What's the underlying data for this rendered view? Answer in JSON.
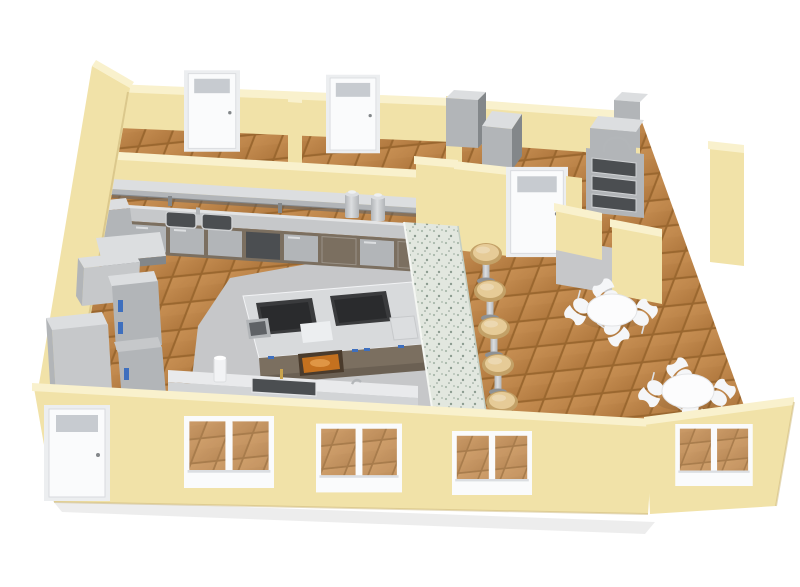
{
  "scene": {
    "title": "3D cutaway floor plan render of a commercial kitchen and dining area",
    "rooms": [
      "commercial kitchen",
      "dining area",
      "storage room left",
      "storage room right",
      "dishwashing corner"
    ],
    "object_counts": {
      "dining_tables": 2,
      "chairs_per_table": 4,
      "bar_stools": 7,
      "back_room_doors": 2,
      "interior_doors": 1,
      "exterior_doors": 1,
      "front_windows": 3,
      "right_windows": 1
    },
    "equipment": [
      "wall-mounted shelf",
      "back prep counter with double sink",
      "coffee urns",
      "under-counter cabinets",
      "cooking island with two ranges",
      "oven with viewing window",
      "reach-in refrigerators",
      "ice machines",
      "hand-wash counter with sink",
      "speckled serving bar counter",
      "triple-basin wash sink with gooseneck faucet",
      "dish machine"
    ],
    "colors": {
      "bg": "#ffffff",
      "wall_face": "#f1e2a8",
      "wall_top": "#f9f1cd",
      "wall_shade": "#dfcd92",
      "wall_dark": "#cdb77b",
      "floor_grout": "#9a672f",
      "floor_tile": "#b1793f",
      "floor_tile_light": "#c68e52",
      "kitchen_floor": "#c6c7c9",
      "steel_light": "#dcdee0",
      "steel_mid": "#b2b5b8",
      "steel_dark": "#83878a",
      "steel_deep": "#5f6266",
      "cabinet_brown": "#7b6f60",
      "counter_top": "#c6c8ca",
      "island_top": "#d8dadc",
      "cooktop": "#3a3b3d",
      "cooktop_inner": "#2a2b2d",
      "oven_frame": "#4a3b2c",
      "oven_glow": "#c4711f",
      "oven_food": "#e29a49",
      "accent_blue": "#3e6fbe",
      "bar_top": "#e2e7df",
      "bar_speckle": "#a9b8ab",
      "bar_speckle_dark": "#8c9c90",
      "stool_seat": "#e6cb97",
      "stool_rim": "#c3a167",
      "chrome": "#b3b6b9",
      "chrome_dark": "#8e9194",
      "door_white": "#fafbfc",
      "door_frame": "#eceef0",
      "glass_gray": "#c7cbd0",
      "table_white": "#fcfcfd",
      "chair_white": "#f5f6f8",
      "chair_stroke": "#dfe1e4",
      "white_counter": "#e9eaec",
      "white_counter_side": "#d2d4d6",
      "sink_dark": "#4b4e51",
      "brass": "#c9a44d",
      "shadow": "rgba(0,0,0,0.07)"
    }
  }
}
